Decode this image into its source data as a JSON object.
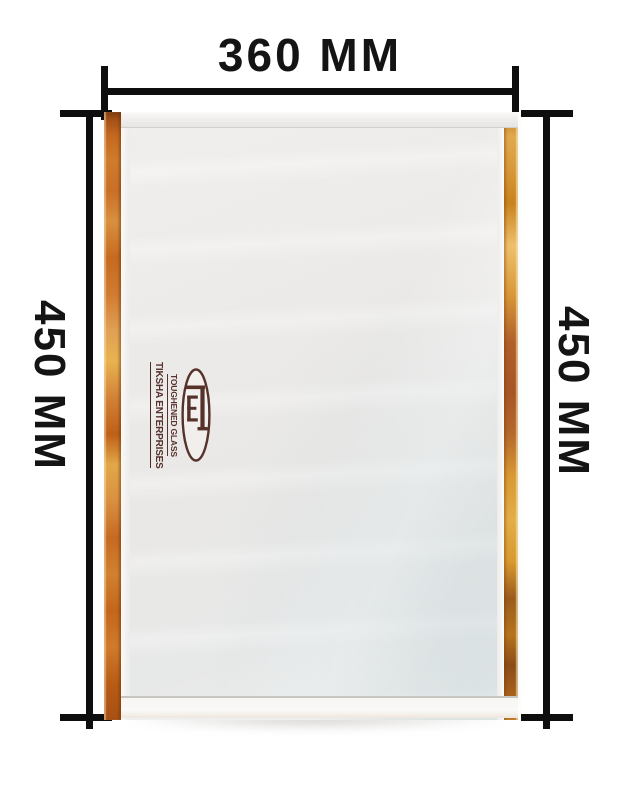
{
  "image": {
    "description": "Product photo of a toughened glass panel with dimension annotations",
    "background": "#ffffff"
  },
  "annotations": {
    "top": {
      "label": "360 MM"
    },
    "left": {
      "label": "450 MM"
    },
    "right": {
      "label": "450 MM"
    },
    "line_color": "#0e0e0e",
    "text_color": "#141414"
  },
  "product": {
    "type": "toughened-glass-panel",
    "surface_color": "#ebeae8",
    "tape_left_colors": [
      "#7e3d10",
      "#c4691f",
      "#d8903f",
      "#e8b34f",
      "#b85c16"
    ],
    "tape_right_colors": [
      "#e0a94e",
      "#d89a3c",
      "#b05f2a",
      "#8a4c16",
      "#eec06c"
    ]
  },
  "logo": {
    "line1": "TIKSHA ENTERPRISES",
    "line2": "TOUGHENED GLASS",
    "monogram": "TE",
    "color": "#4a231c"
  }
}
